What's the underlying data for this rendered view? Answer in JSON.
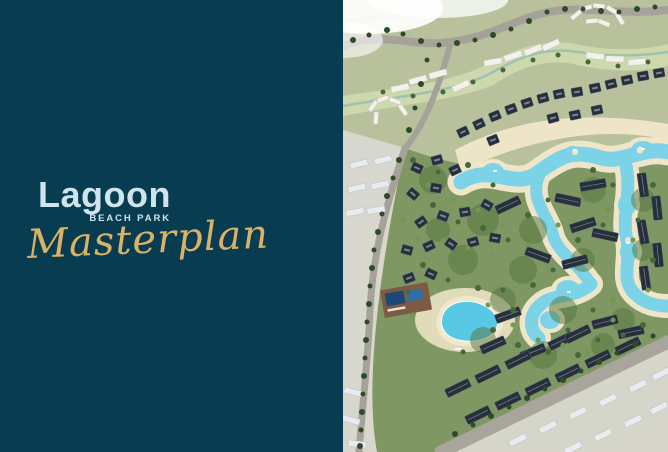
{
  "brand": {
    "title": "Lagoon",
    "subtitle": "BEACH PARK",
    "tagline": "Masterplan"
  },
  "theme": {
    "panel_bg": "#083c51",
    "title_color": "#cfe4ec",
    "gold": "#d9b267"
  },
  "map": {
    "label": "Lagoon Beach Park masterplan aerial rendering",
    "palette": {
      "water": "#7cd3e8",
      "pool_deep": "#1c4a77",
      "sand": "#efe6c9",
      "greenery": "#7f9763",
      "terrain": "#b8c19c",
      "buildings": "#262f3a",
      "road": "#a5a29a",
      "faded": "#d8d7cd"
    }
  }
}
